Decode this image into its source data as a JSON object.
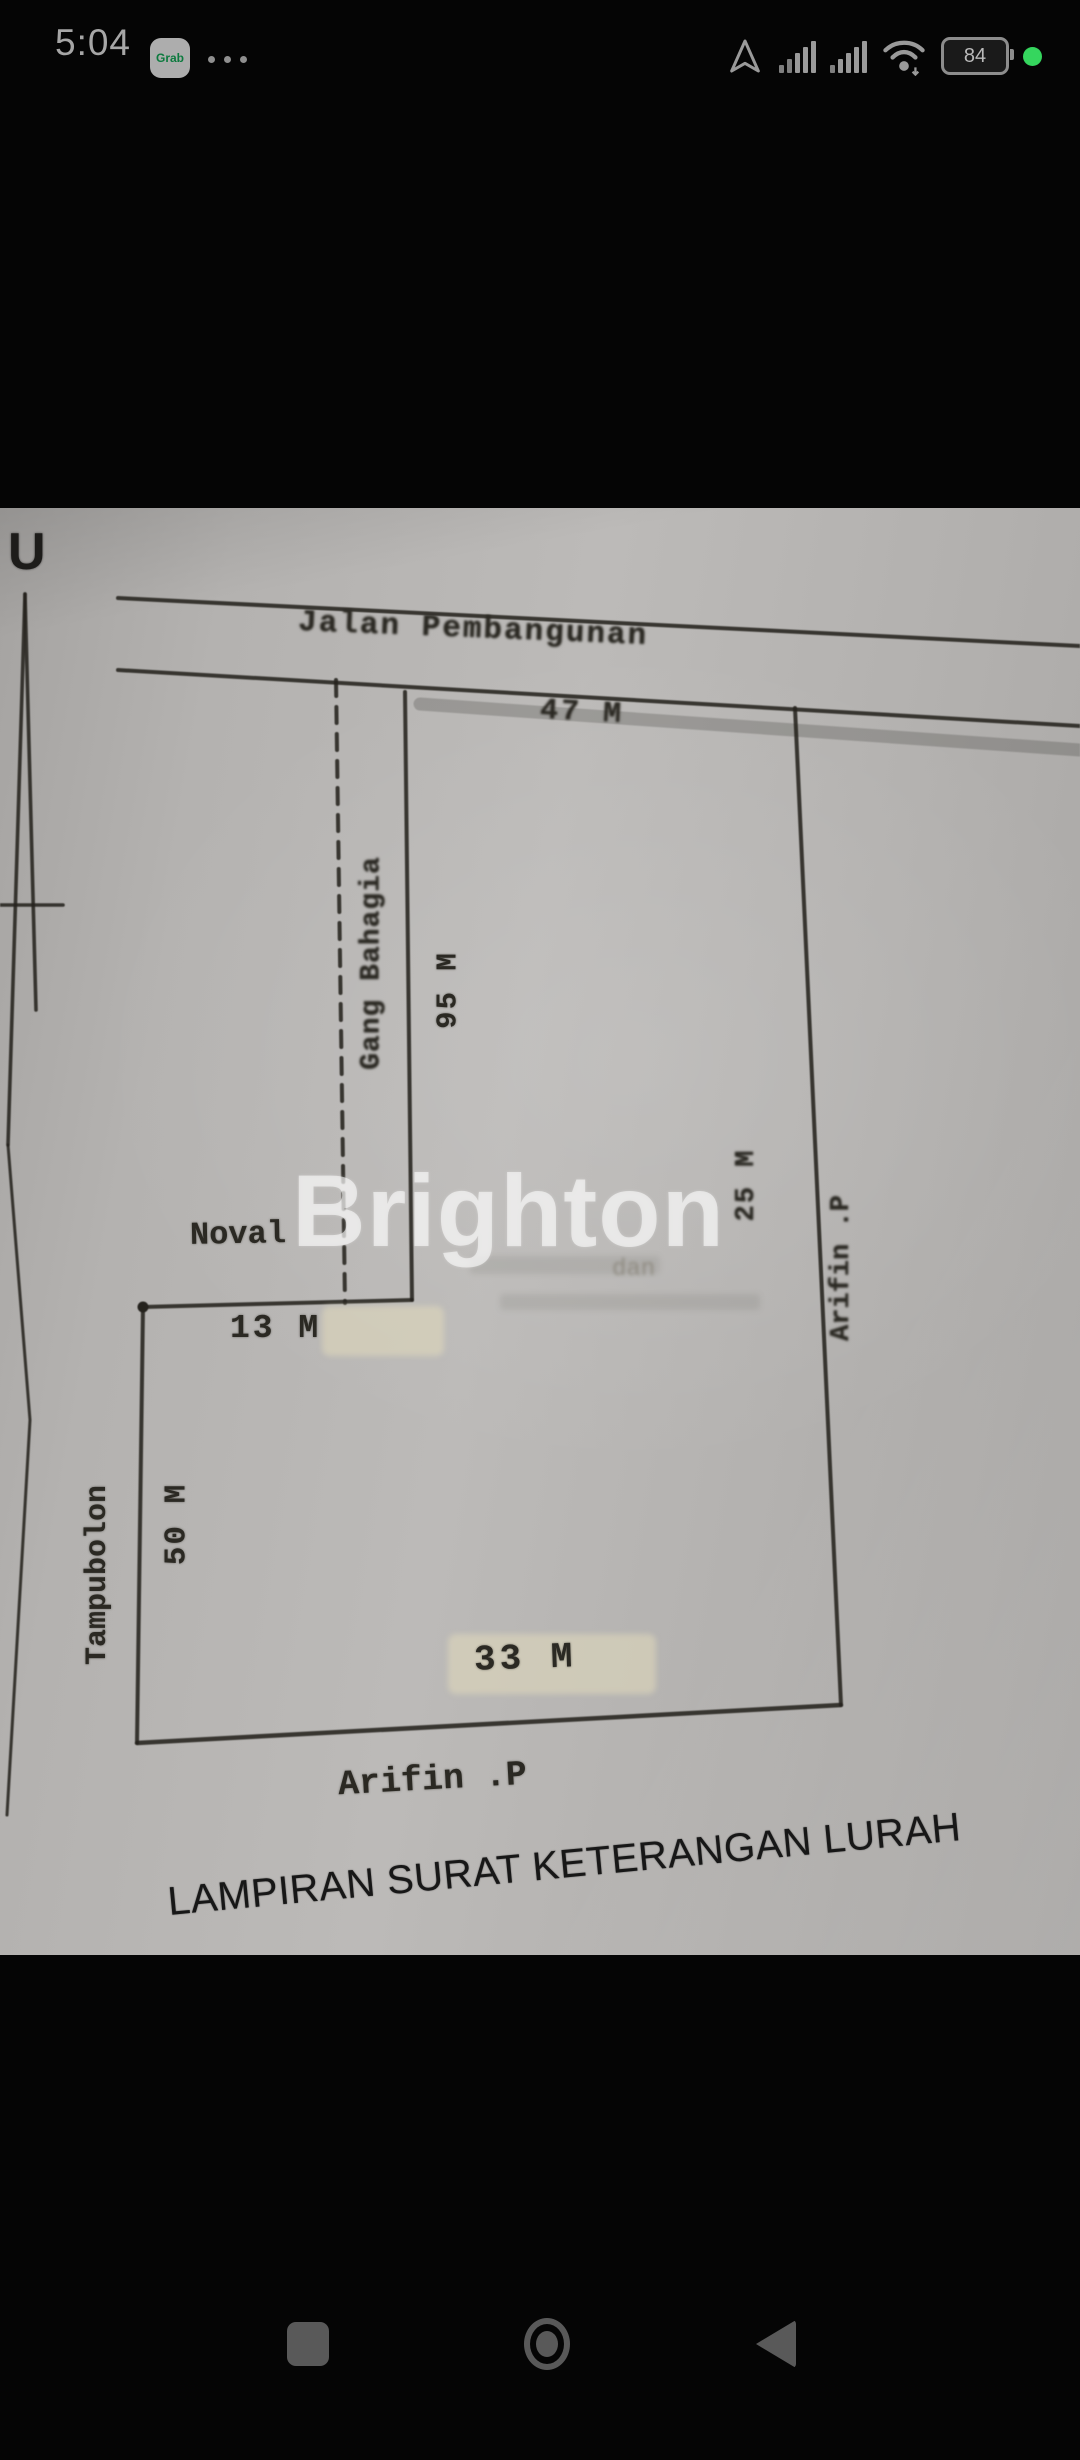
{
  "status_bar": {
    "time": "5:04",
    "grab_label": "Grab",
    "battery_percent": "84"
  },
  "diagram": {
    "north_label": "U",
    "road_label": "Jalan Pembangunan",
    "alley_label": "Gang Bahagia",
    "dim_road_front": "47 M",
    "dim_alley_depth": "95 M",
    "dim_right_depth": "25 M",
    "dim_noval_front": "13 M",
    "dim_left_depth": "50 M",
    "dim_bottom_width": "33 M",
    "neighbor_noval": "Noval",
    "neighbor_left": "Tampubolon",
    "neighbor_right": "Arifin .P",
    "neighbor_bottom": "Arifin .P",
    "bleed_fragment": "dan",
    "caption": "LAMPIRAN SURAT KETERANGAN LURAH",
    "watermark": "Brighton",
    "colors": {
      "paper": "#b4b2b0",
      "ink": "#2b2923",
      "watermark_white": "#fcfcfc",
      "highlight": "#e2dabc",
      "status_green_dot": "#35d65e"
    }
  }
}
